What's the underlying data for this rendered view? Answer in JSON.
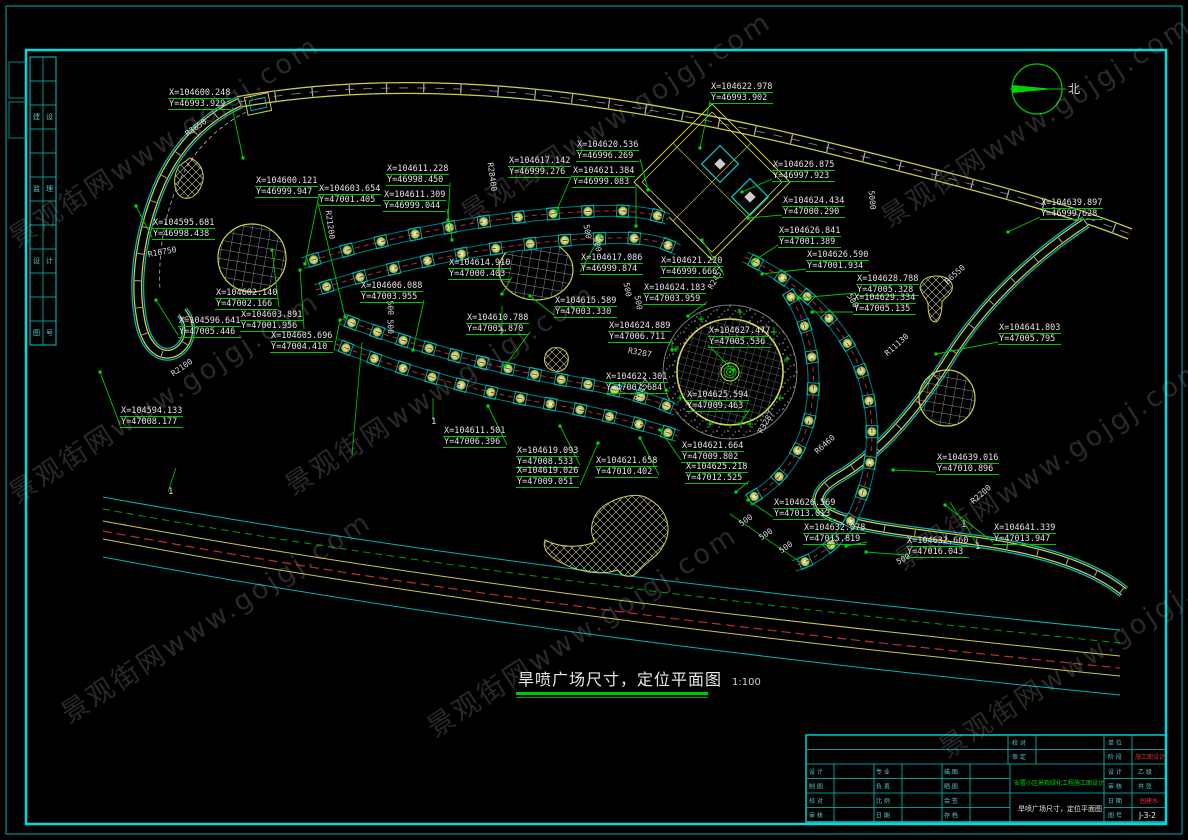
{
  "compass": {
    "label": "北"
  },
  "main_title": {
    "text": "旱喷广场尺寸，定位平面图",
    "scale": "1:100"
  },
  "watermark": {
    "text": "景观街网www.gojgj.com",
    "positions": [
      [
        0,
        222
      ],
      [
        452,
        198
      ],
      [
        872,
        202
      ],
      [
        0,
        478
      ],
      [
        276,
        470
      ],
      [
        886,
        545
      ],
      [
        52,
        698
      ],
      [
        418,
        712
      ],
      [
        930,
        733
      ]
    ]
  },
  "coordinate_labels": [
    {
      "x": 168,
      "y": 88,
      "l1": "X=104600.248",
      "l2": "Y=46993.929",
      "px": 243,
      "py": 158
    },
    {
      "x": 255,
      "y": 176,
      "l1": "X=104600.121",
      "l2": "Y=46999.947",
      "px": 305,
      "py": 264
    },
    {
      "x": 318,
      "y": 184,
      "l1": "X=104603.654",
      "l2": "Y=47001.405",
      "px": 345,
      "py": 317
    },
    {
      "x": 386,
      "y": 164,
      "l1": "X=104611.228",
      "l2": "Y=46998.450",
      "px": 448,
      "py": 220
    },
    {
      "x": 383,
      "y": 190,
      "l1": "X=104611.309",
      "l2": "Y=46999.044",
      "px": 452,
      "py": 240
    },
    {
      "x": 508,
      "y": 156,
      "l1": "X=104617.142",
      "l2": "Y=46999.276",
      "px": 556,
      "py": 212
    },
    {
      "x": 576,
      "y": 140,
      "l1": "X=104620.536",
      "l2": "Y=46996.269",
      "px": 648,
      "py": 190
    },
    {
      "x": 710,
      "y": 82,
      "l1": "X=104622.978",
      "l2": "Y=46993.902",
      "px": 700,
      "py": 148
    },
    {
      "x": 572,
      "y": 166,
      "l1": "X=104621.384",
      "l2": "Y=46999.083",
      "px": 636,
      "py": 226
    },
    {
      "x": 772,
      "y": 160,
      "l1": "X=104626.875",
      "l2": "Y=46997.923",
      "px": 742,
      "py": 192
    },
    {
      "x": 782,
      "y": 196,
      "l1": "X=104624.434",
      "l2": "Y=47000.290",
      "px": 748,
      "py": 218
    },
    {
      "x": 1040,
      "y": 198,
      "l1": "X=104639.897",
      "l2": "Y=46999.628",
      "px": 1008,
      "py": 232
    },
    {
      "x": 152,
      "y": 218,
      "l1": "X=104595.681",
      "l2": "Y=46998.438",
      "px": 136,
      "py": 206
    },
    {
      "x": 215,
      "y": 288,
      "l1": "X=104602.140",
      "l2": "Y=47002.166",
      "px": 272,
      "py": 250
    },
    {
      "x": 240,
      "y": 310,
      "l1": "X=104603.891",
      "l2": "Y=47001.956",
      "px": 300,
      "py": 270
    },
    {
      "x": 178,
      "y": 316,
      "l1": "X=104596.641",
      "l2": "Y=47005.446",
      "px": 156,
      "py": 300
    },
    {
      "x": 270,
      "y": 331,
      "l1": "X=104605.696",
      "l2": "Y=47004.410",
      "px": 340,
      "py": 320
    },
    {
      "x": 120,
      "y": 406,
      "l1": "X=104594.133",
      "l2": "Y=47008.177",
      "px": 100,
      "py": 372
    },
    {
      "x": 360,
      "y": 281,
      "l1": "X=104606.088",
      "l2": "Y=47003.955",
      "px": 413,
      "py": 350
    },
    {
      "x": 448,
      "y": 258,
      "l1": "X=104614.910",
      "l2": "Y=47000.403",
      "px": 502,
      "py": 294
    },
    {
      "x": 466,
      "y": 313,
      "l1": "X=104610.788",
      "l2": "Y=47005.870",
      "px": 505,
      "py": 366
    },
    {
      "x": 554,
      "y": 296,
      "l1": "X=104615.589",
      "l2": "Y=47003.330",
      "px": 530,
      "py": 296
    },
    {
      "x": 580,
      "y": 253,
      "l1": "X=104617.086",
      "l2": "Y=46999.874",
      "px": 600,
      "py": 236
    },
    {
      "x": 660,
      "y": 256,
      "l1": "X=104621.220",
      "l2": "Y=46999.666",
      "px": 702,
      "py": 240
    },
    {
      "x": 643,
      "y": 283,
      "l1": "X=104624.183",
      "l2": "Y=47003.959",
      "px": 688,
      "py": 316
    },
    {
      "x": 778,
      "y": 226,
      "l1": "X=104626.841",
      "l2": "Y=47001.389",
      "px": 752,
      "py": 262
    },
    {
      "x": 806,
      "y": 250,
      "l1": "X=104626.590",
      "l2": "Y=47001.934",
      "px": 762,
      "py": 274
    },
    {
      "x": 856,
      "y": 274,
      "l1": "X=104628.788",
      "l2": "Y=47005.328",
      "px": 798,
      "py": 298
    },
    {
      "x": 853,
      "y": 293,
      "l1": "X=104629.334",
      "l2": "Y=47005.135",
      "px": 812,
      "py": 312
    },
    {
      "x": 998,
      "y": 323,
      "l1": "X=104641.803",
      "l2": "Y=47005.795",
      "px": 936,
      "py": 354
    },
    {
      "x": 608,
      "y": 321,
      "l1": "X=104624.889",
      "l2": "Y=47006.711",
      "px": 672,
      "py": 350
    },
    {
      "x": 708,
      "y": 326,
      "l1": "X=104627.477",
      "l2": "Y=47005.536",
      "px": 733,
      "py": 370
    },
    {
      "x": 605,
      "y": 372,
      "l1": "X=104622.301",
      "l2": "Y=47007.684",
      "px": 666,
      "py": 390
    },
    {
      "x": 686,
      "y": 390,
      "l1": "X=104625.594",
      "l2": "Y=47009.463",
      "px": 740,
      "py": 424
    },
    {
      "x": 443,
      "y": 426,
      "l1": "X=104611.501",
      "l2": "Y=47006.396",
      "px": 488,
      "py": 406
    },
    {
      "x": 516,
      "y": 446,
      "l1": "X=104619.093",
      "l2": "Y=47008.533",
      "px": 560,
      "py": 426
    },
    {
      "x": 516,
      "y": 466,
      "l1": "X=104619.026",
      "l2": "Y=47009.051",
      "px": 598,
      "py": 443
    },
    {
      "x": 595,
      "y": 456,
      "l1": "X=104621.658",
      "l2": "Y=47010.402",
      "px": 640,
      "py": 438
    },
    {
      "x": 681,
      "y": 441,
      "l1": "X=104621.664",
      "l2": "Y=47009.802",
      "px": 660,
      "py": 430
    },
    {
      "x": 685,
      "y": 462,
      "l1": "X=104625.218",
      "l2": "Y=47012.525",
      "px": 736,
      "py": 492
    },
    {
      "x": 773,
      "y": 498,
      "l1": "X=104626.569",
      "l2": "Y=47013.013",
      "px": 748,
      "py": 500
    },
    {
      "x": 803,
      "y": 523,
      "l1": "X=104632.078",
      "l2": "Y=47015.819",
      "px": 846,
      "py": 546
    },
    {
      "x": 906,
      "y": 536,
      "l1": "X=104632.660",
      "l2": "Y=47016.043",
      "px": 866,
      "py": 552
    },
    {
      "x": 936,
      "y": 453,
      "l1": "X=104639.016",
      "l2": "Y=47010.896",
      "px": 893,
      "py": 470
    },
    {
      "x": 993,
      "y": 523,
      "l1": "X=104641.339",
      "l2": "Y=47013.947",
      "px": 945,
      "py": 505
    }
  ],
  "radius_labels": [
    {
      "x": 186,
      "y": 130,
      "text": "R3650",
      "angle": -35
    },
    {
      "x": 148,
      "y": 250,
      "text": "R16750",
      "angle": -10
    },
    {
      "x": 172,
      "y": 370,
      "text": "R2100",
      "angle": -35
    },
    {
      "x": 328,
      "y": 206,
      "text": "R21200",
      "angle": 82
    },
    {
      "x": 490,
      "y": 158,
      "text": "R28400",
      "angle": 82
    },
    {
      "x": 628,
      "y": 346,
      "text": "R3287",
      "angle": 10
    },
    {
      "x": 636,
      "y": 396,
      "text": "R2457",
      "angle": -60
    },
    {
      "x": 710,
      "y": 284,
      "text": "R2457",
      "angle": -60
    },
    {
      "x": 760,
      "y": 428,
      "text": "R3287",
      "angle": -60
    },
    {
      "x": 816,
      "y": 448,
      "text": "R6460",
      "angle": -42
    },
    {
      "x": 886,
      "y": 350,
      "text": "R11130",
      "angle": -42
    },
    {
      "x": 946,
      "y": 278,
      "text": "R6550",
      "angle": -42
    },
    {
      "x": 972,
      "y": 498,
      "text": "R2200",
      "angle": -42
    }
  ],
  "dim_labels": [
    {
      "x": 586,
      "y": 220,
      "text": "500",
      "angle": 80
    },
    {
      "x": 596,
      "y": 233,
      "text": "500",
      "angle": 80
    },
    {
      "x": 626,
      "y": 278,
      "text": "500",
      "angle": 80
    },
    {
      "x": 637,
      "y": 291,
      "text": "500",
      "angle": 80
    },
    {
      "x": 849,
      "y": 290,
      "text": "500",
      "angle": 60
    },
    {
      "x": 871,
      "y": 186,
      "text": "5000",
      "angle": 84
    },
    {
      "x": 740,
      "y": 520,
      "text": "500",
      "angle": -35
    },
    {
      "x": 760,
      "y": 534,
      "text": "500",
      "angle": -35
    },
    {
      "x": 780,
      "y": 547,
      "text": "500",
      "angle": -35
    },
    {
      "x": 897,
      "y": 558,
      "text": "500",
      "angle": -28
    },
    {
      "x": 390,
      "y": 296,
      "text": "500",
      "angle": 88
    },
    {
      "x": 390,
      "y": 315,
      "text": "500",
      "angle": 88
    }
  ],
  "markers": [
    {
      "x": 168,
      "y": 487,
      "text": "1"
    },
    {
      "x": 431,
      "y": 417,
      "text": "1"
    },
    {
      "x": 499,
      "y": 328,
      "text": "2"
    },
    {
      "x": 961,
      "y": 520,
      "text": "1"
    },
    {
      "x": 975,
      "y": 542,
      "text": "1"
    }
  ],
  "extra_lines": [
    [
      352,
      455,
      362,
      342
    ],
    [
      433,
      420,
      433,
      398
    ],
    [
      502,
      336,
      502,
      306
    ],
    [
      168,
      492,
      176,
      468
    ],
    [
      962,
      521,
      950,
      502
    ],
    [
      976,
      543,
      963,
      520
    ],
    [
      730,
      514,
      800,
      562
    ]
  ],
  "bands": [
    {
      "path": "M303,263 C400,233 505,214 600,211 C628,210 652,213 668,219",
      "plants": 11
    },
    {
      "path": "M316,290 C415,259 520,240 612,238 C645,237 664,242 678,250",
      "plants": 11
    },
    {
      "path": "M342,319 C420,349 500,369 580,383 C620,390 652,399 676,410",
      "plants": 13
    },
    {
      "path": "M336,344 C405,372 475,391 550,404 C600,413 642,424 678,436",
      "plants": 12
    },
    {
      "path": "M745,257 C800,283 840,320 860,368 C877,413 876,465 856,510 C845,536 824,556 794,566",
      "plants": 13
    },
    {
      "path": "M787,291 C812,328 820,378 808,424 C799,456 780,483 748,500",
      "plants": 8
    }
  ],
  "side_strip": {
    "x": 30,
    "y": 57,
    "col_w": 13,
    "cols": 2,
    "rows": 12,
    "row_h": 24,
    "texts": [
      {
        "r": 2,
        "c": 0,
        "t": "建"
      },
      {
        "r": 2,
        "c": 1,
        "t": "设"
      },
      {
        "r": 5,
        "c": 0,
        "t": "监"
      },
      {
        "r": 5,
        "c": 1,
        "t": "理"
      },
      {
        "r": 8,
        "c": 0,
        "t": "设"
      },
      {
        "r": 8,
        "c": 1,
        "t": "计"
      },
      {
        "r": 11,
        "c": 0,
        "t": "图"
      },
      {
        "r": 11,
        "c": 1,
        "t": "号"
      }
    ]
  },
  "title_block": {
    "x": 806,
    "y": 735,
    "w": 360,
    "h": 87,
    "h_lines": [
      [
        0,
        360,
        14.5
      ],
      [
        0,
        360,
        29
      ],
      [
        0,
        204,
        43.5
      ],
      [
        298,
        360,
        43.5
      ],
      [
        0,
        360,
        58
      ],
      [
        0,
        204,
        72.5
      ],
      [
        298,
        360,
        72.5
      ]
    ],
    "v_lines": [
      [
        202,
        0,
        29
      ],
      [
        230,
        0,
        29
      ],
      [
        298,
        0,
        87
      ],
      [
        326,
        0,
        87
      ],
      [
        28,
        29,
        87
      ],
      [
        68,
        29,
        87
      ],
      [
        96,
        29,
        87
      ],
      [
        136,
        29,
        87
      ],
      [
        164,
        29,
        87
      ],
      [
        204,
        29,
        87
      ]
    ],
    "texts": [
      {
        "x": 206,
        "y": 10,
        "t": "校 对",
        "c": "#55c8c8",
        "s": 6
      },
      {
        "x": 206,
        "y": 24,
        "t": "审 定",
        "c": "#55c8c8",
        "s": 6
      },
      {
        "x": 302,
        "y": 10,
        "t": "单 位",
        "c": "#55c8c8",
        "s": 6
      },
      {
        "x": 302,
        "y": 24,
        "t": "阶 段",
        "c": "#55c8c8",
        "s": 6
      },
      {
        "x": 329,
        "y": 24,
        "t": "施工图设计",
        "c": "#e03030",
        "s": 6
      },
      {
        "x": 3,
        "y": 39,
        "t": "设 计",
        "c": "#55c8c8",
        "s": 6
      },
      {
        "x": 3,
        "y": 53.5,
        "t": "制 图",
        "c": "#55c8c8",
        "s": 6
      },
      {
        "x": 3,
        "y": 68,
        "t": "校 对",
        "c": "#55c8c8",
        "s": 6
      },
      {
        "x": 3,
        "y": 82.5,
        "t": "审 核",
        "c": "#55c8c8",
        "s": 6
      },
      {
        "x": 70,
        "y": 39,
        "t": "专 业",
        "c": "#55c8c8",
        "s": 6
      },
      {
        "x": 70,
        "y": 53.5,
        "t": "负 责",
        "c": "#55c8c8",
        "s": 6
      },
      {
        "x": 70,
        "y": 68,
        "t": "比 例",
        "c": "#55c8c8",
        "s": 6
      },
      {
        "x": 70,
        "y": 82.5,
        "t": "日 期",
        "c": "#55c8c8",
        "s": 6
      },
      {
        "x": 138,
        "y": 39,
        "t": "描 图",
        "c": "#55c8c8",
        "s": 6
      },
      {
        "x": 138,
        "y": 53.5,
        "t": "晒 图",
        "c": "#55c8c8",
        "s": 6
      },
      {
        "x": 138,
        "y": 68,
        "t": "会 签",
        "c": "#55c8c8",
        "s": 6
      },
      {
        "x": 138,
        "y": 82.5,
        "t": "存 档",
        "c": "#55c8c8",
        "s": 6
      },
      {
        "x": 208,
        "y": 50,
        "t": "安置小区景观绿化工程施工图设计",
        "c": "#00d400",
        "s": 6
      },
      {
        "x": 212,
        "y": 76,
        "t": "旱喷广场尺寸，定位平面图",
        "c": "#e8e8e8",
        "s": 7
      },
      {
        "x": 302,
        "y": 39,
        "t": "设 计",
        "c": "#55c8c8",
        "s": 6
      },
      {
        "x": 302,
        "y": 53.5,
        "t": "审 核",
        "c": "#55c8c8",
        "s": 6
      },
      {
        "x": 302,
        "y": 68,
        "t": "日 期",
        "c": "#55c8c8",
        "s": 6
      },
      {
        "x": 302,
        "y": 82.5,
        "t": "图 号",
        "c": "#55c8c8",
        "s": 6
      },
      {
        "x": 332,
        "y": 39,
        "t": "乙 级",
        "c": "#55c8c8",
        "s": 6
      },
      {
        "x": 332,
        "y": 53.5,
        "t": "共 张",
        "c": "#55c8c8",
        "s": 6
      },
      {
        "x": 334,
        "y": 68,
        "t": "园建水",
        "c": "#e03030",
        "s": 6
      },
      {
        "x": 333,
        "y": 83,
        "t": "J-3-2",
        "c": "#efefef",
        "s": 7.5
      }
    ]
  }
}
